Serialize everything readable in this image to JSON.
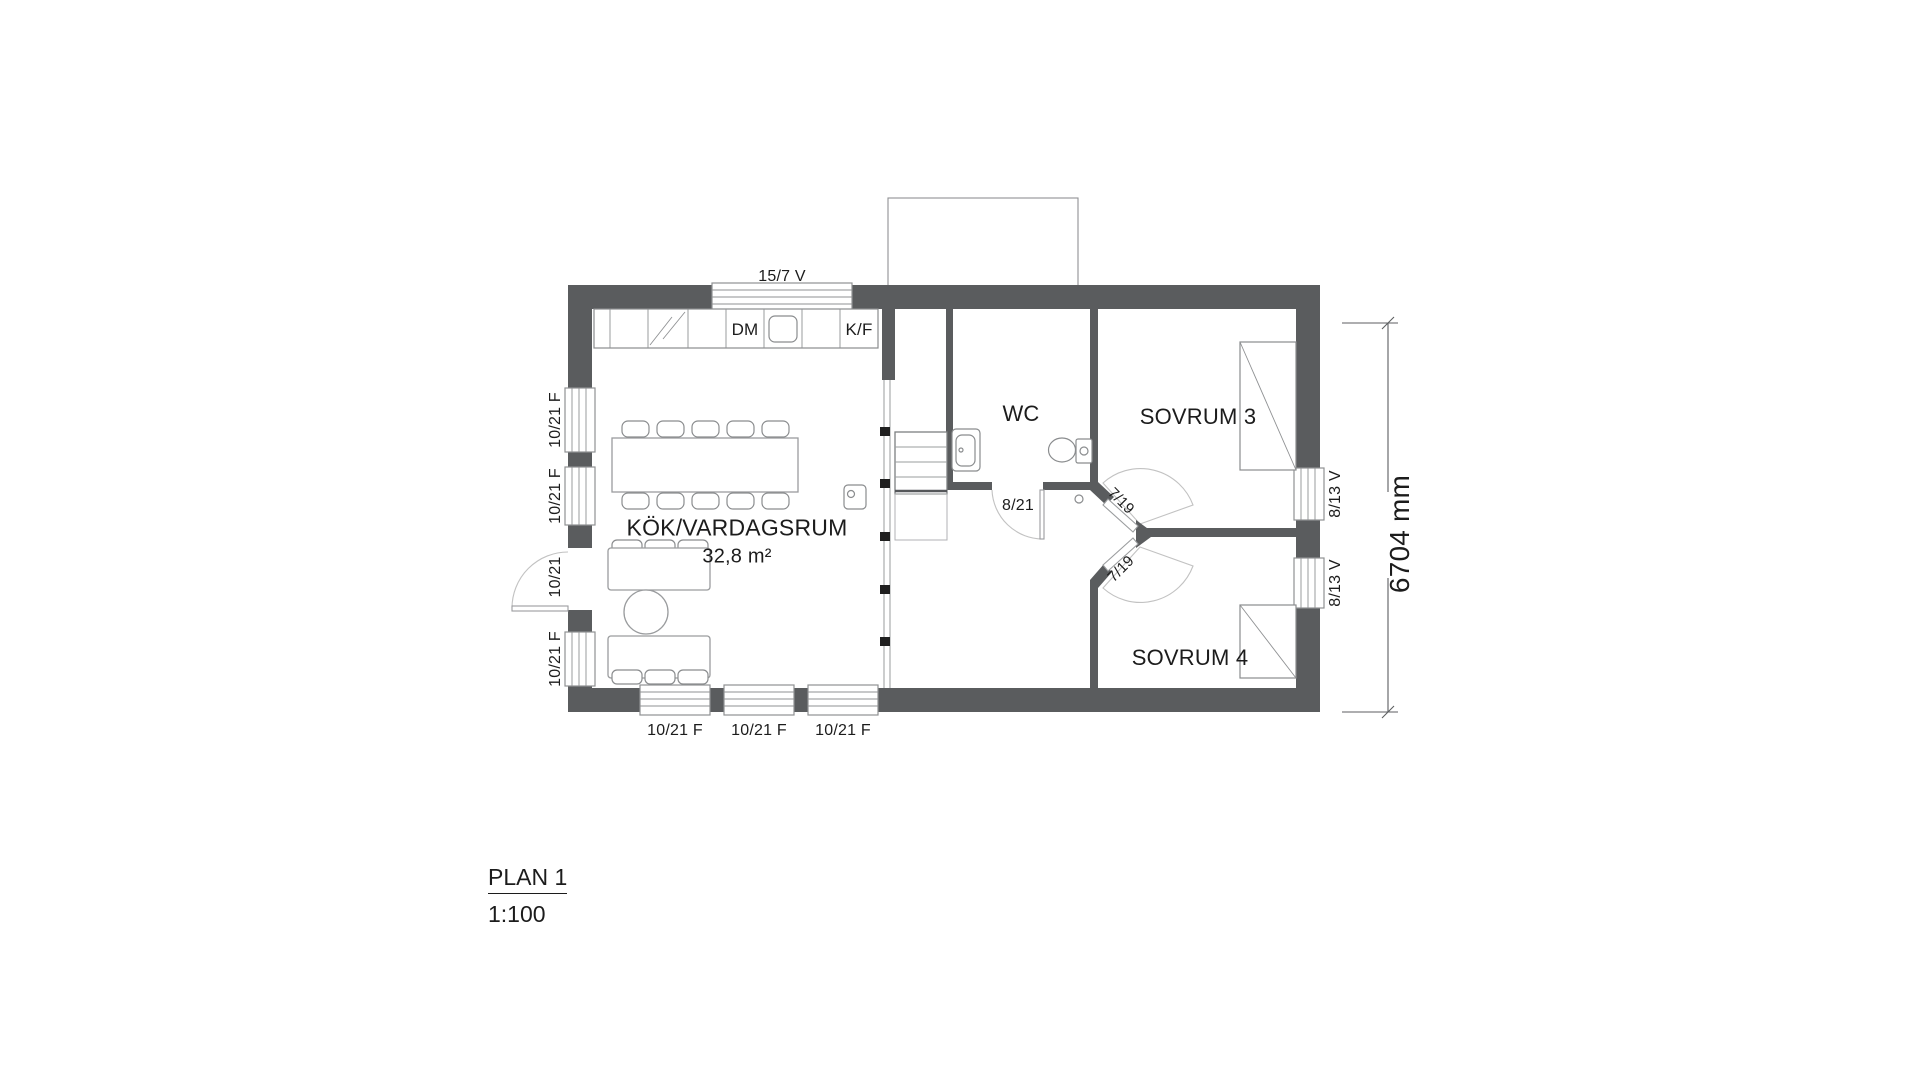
{
  "title": {
    "name": "PLAN 1",
    "scale": "1:100"
  },
  "rooms": {
    "kitchen_living": {
      "label": "KÖK/VARDAGSRUM",
      "area": "32,8 m²"
    },
    "wc": {
      "label": "WC"
    },
    "bedroom3": {
      "label": "SOVRUM 3"
    },
    "bedroom4": {
      "label": "SOVRUM 4"
    }
  },
  "appliances": {
    "dishwasher": "DM",
    "fridge_freezer": "K/F"
  },
  "openings": {
    "top_window": "15/7 V",
    "left_window_1": "10/21 F",
    "left_window_2": "10/21 F",
    "entrance_door": "10/21",
    "left_window_3": "10/21 F",
    "bottom_window_1": "10/21 F",
    "bottom_window_2": "10/21 F",
    "bottom_window_3": "10/21 F",
    "right_window_1": "8/13 V",
    "right_window_2": "8/13 V",
    "wc_door": "8/21",
    "bedroom3_door": "7/19",
    "bedroom4_door": "7/19"
  },
  "dimensions": {
    "vertical_total": "6704 mm"
  },
  "colors": {
    "wall": "#5a5c5e",
    "line": "#8f9193",
    "arc": "#c2c2c2",
    "text": "#1c1c1c",
    "post": "#1f1f1f"
  }
}
